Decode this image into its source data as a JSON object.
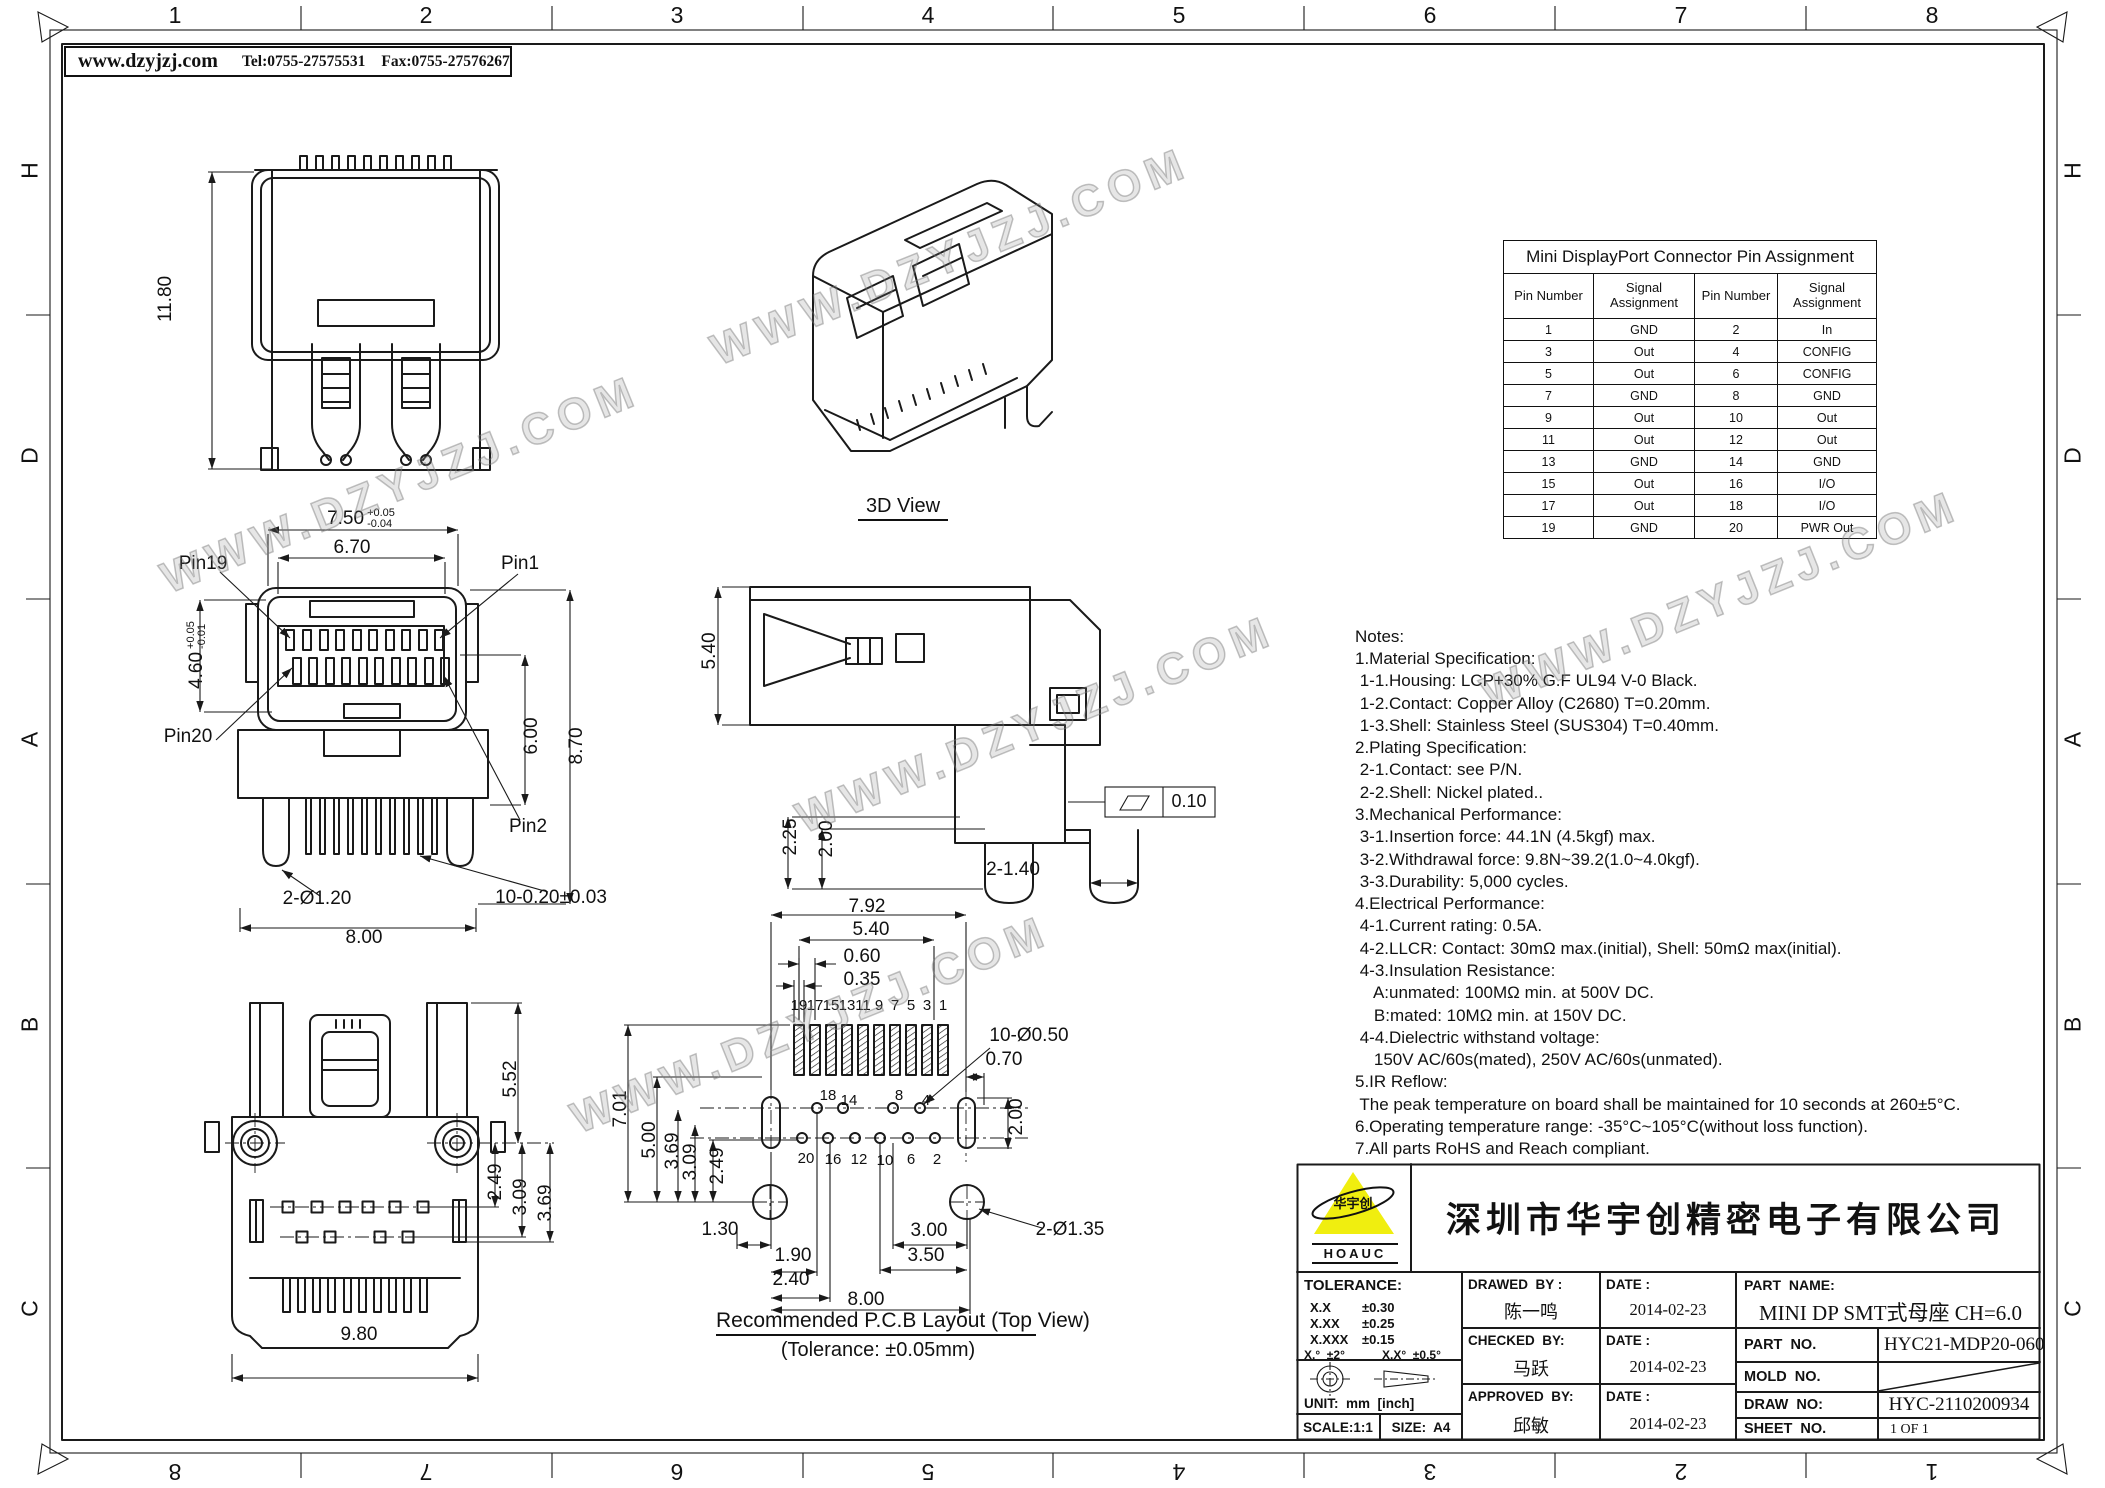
{
  "watermark": {
    "text": "WWW.DZYJZJ.COM"
  },
  "header": {
    "website": "www.dzyjzj.com",
    "tel": "Tel:0755-27575531",
    "fax": "Fax:0755-27576267"
  },
  "frame": {
    "cols": [
      "1",
      "2",
      "3",
      "4",
      "5",
      "6",
      "7",
      "8"
    ],
    "rows": [
      "H",
      "D",
      "A",
      "B",
      "C"
    ]
  },
  "rear_view": {
    "height": "11.80"
  },
  "iso_view": {
    "label": "3D View"
  },
  "front_view": {
    "pin19": "Pin19",
    "pin1": "Pin1",
    "pin20": "Pin20",
    "pin2": "Pin2",
    "w_outer": "7.50",
    "w_outer_tp": "+0.05",
    "w_outer_tm": "-0.04",
    "w_inner": "6.70",
    "h_open": "4.60",
    "h_open_tp": "+0.05",
    "h_open_tm": "-0.01",
    "h_body": "8.70",
    "h_inner": "6.00",
    "legs": "2-Ø1.20",
    "pins": "10-0.20±0.03",
    "w_base": "8.00"
  },
  "side_view": {
    "h_body": "5.40",
    "leg_a": "2.25",
    "leg_b": "2.00",
    "feet": "2-1.40",
    "flatness": "0.10"
  },
  "bottom_view": {
    "h_top": "5.52",
    "p1": "2.49",
    "p2": "3.09",
    "p3": "3.69",
    "width": "9.80"
  },
  "pcb_view": {
    "w_pads": "7.92",
    "w_inner": "5.40",
    "pitch": "0.60",
    "pad_w": "0.35",
    "h_total": "7.01",
    "h_a": "5.00",
    "h_b": "3.69",
    "h_c": "3.09",
    "h_d": "2.49",
    "holes": "10-Ø0.50",
    "offset": "0.70",
    "slot_h": "2.00",
    "b1": "1.30",
    "b2": "1.90",
    "b3": "2.40",
    "b4": "3.00",
    "b5": "3.50",
    "b6": "8.00",
    "mounts": "2-Ø1.35",
    "top_pins": [
      "19",
      "17",
      "15",
      "13",
      "11",
      "9",
      "7",
      "5",
      "3",
      "1"
    ],
    "mid_pins": [
      "18",
      "14",
      "8",
      "4"
    ],
    "bot_pins": [
      "20",
      "16",
      "12",
      "10",
      "6",
      "2"
    ],
    "caption": "Recommended P.C.B Layout (Top View)",
    "tolerance_note": "(Tolerance: ±0.05mm)"
  },
  "pin_table": {
    "title": "Mini DisplayPort Connector Pin Assignment",
    "headers": [
      "Pin Number",
      "Signal Assignment",
      "Pin Number",
      "Signal Assignment"
    ],
    "rows": [
      [
        "1",
        "GND",
        "2",
        "In"
      ],
      [
        "3",
        "Out",
        "4",
        "CONFIG"
      ],
      [
        "5",
        "Out",
        "6",
        "CONFIG"
      ],
      [
        "7",
        "GND",
        "8",
        "GND"
      ],
      [
        "9",
        "Out",
        "10",
        "Out"
      ],
      [
        "11",
        "Out",
        "12",
        "Out"
      ],
      [
        "13",
        "GND",
        "14",
        "GND"
      ],
      [
        "15",
        "Out",
        "16",
        "I/O"
      ],
      [
        "17",
        "Out",
        "18",
        "I/O"
      ],
      [
        "19",
        "GND",
        "20",
        "PWR Out"
      ]
    ]
  },
  "notes": {
    "lines": [
      "Notes:",
      "1.Material Specification:",
      " 1-1.Housing: LCP+30% G.F UL94 V-0 Black.",
      " 1-2.Contact: Copper Alloy (C2680) T=0.20mm.",
      " 1-3.Shell: Stainless Steel (SUS304) T=0.40mm.",
      "2.Plating Specification:",
      " 2-1.Contact: see P/N.",
      " 2-2.Shell: Nickel plated..",
      "3.Mechanical Performance:",
      " 3-1.Insertion force: 44.1N (4.5kgf) max.",
      " 3-2.Withdrawal force: 9.8N~39.2(1.0~4.0kgf).",
      " 3-3.Durability: 5,000 cycles.",
      "4.Electrical Performance:",
      " 4-1.Current rating: 0.5A.",
      " 4-2.LLCR: Contact: 30mΩ max.(initial), Shell: 50mΩ max(initial).",
      " 4-3.Insulation Resistance:",
      "    A:unmated: 100MΩ min. at 500V DC.",
      "    B:mated: 10MΩ min. at 150V DC.",
      " 4-4.Dielectric withstand voltage:",
      "    150V AC/60s(mated), 250V AC/60s(unmated).",
      "5.IR Reflow:",
      " The peak temperature on board shall be maintained for 10 seconds at 260±5°C.",
      "6.Operating temperature range: -35°C~105°C(without loss function).",
      "7.All parts RoHS and Reach compliant."
    ]
  },
  "title_block": {
    "logo_cn": "华宇创",
    "logo_en": "HOAUC",
    "company": "深圳市华宇创精密电子有限公司",
    "tolerance_title": "TOLERANCE:",
    "tol1_l": "X.X",
    "tol1_v": "±0.30",
    "tol2_l": "X.XX",
    "tol2_v": "±0.25",
    "tol3_l": "X.XXX",
    "tol3_v": "±0.15",
    "tol_ang1": "X.°  ±2°",
    "tol_ang2": "X.X°  ±0.5°",
    "unit": "UNIT:  mm  [inch]",
    "scale": "SCALE:1:1",
    "size": "SIZE:  A4",
    "drawed_label": "DRAWED  BY :",
    "checked_label": "CHECKED  BY:",
    "approved_label": "APPROVED  BY:",
    "date_label": "DATE :",
    "drawed_by": "陈一鸣",
    "checked_by": "马跃",
    "approved_by": "邱敏",
    "date_drawed": "2014-02-23",
    "date_checked": "2014-02-23",
    "date_approved": "2014-02-23",
    "part_name_label": "PART  NAME:",
    "part_name": "MINI DP SMT式母座 CH=6.0",
    "part_no_label": "PART  NO.",
    "part_no": "HYC21-MDP20-060",
    "mold_no_label": "MOLD  NO.",
    "draw_no_label": "DRAW  NO:",
    "draw_no": "HYC-2110200934",
    "sheet_no_label": "SHEET  NO.",
    "sheet_no": "1 OF 1"
  }
}
